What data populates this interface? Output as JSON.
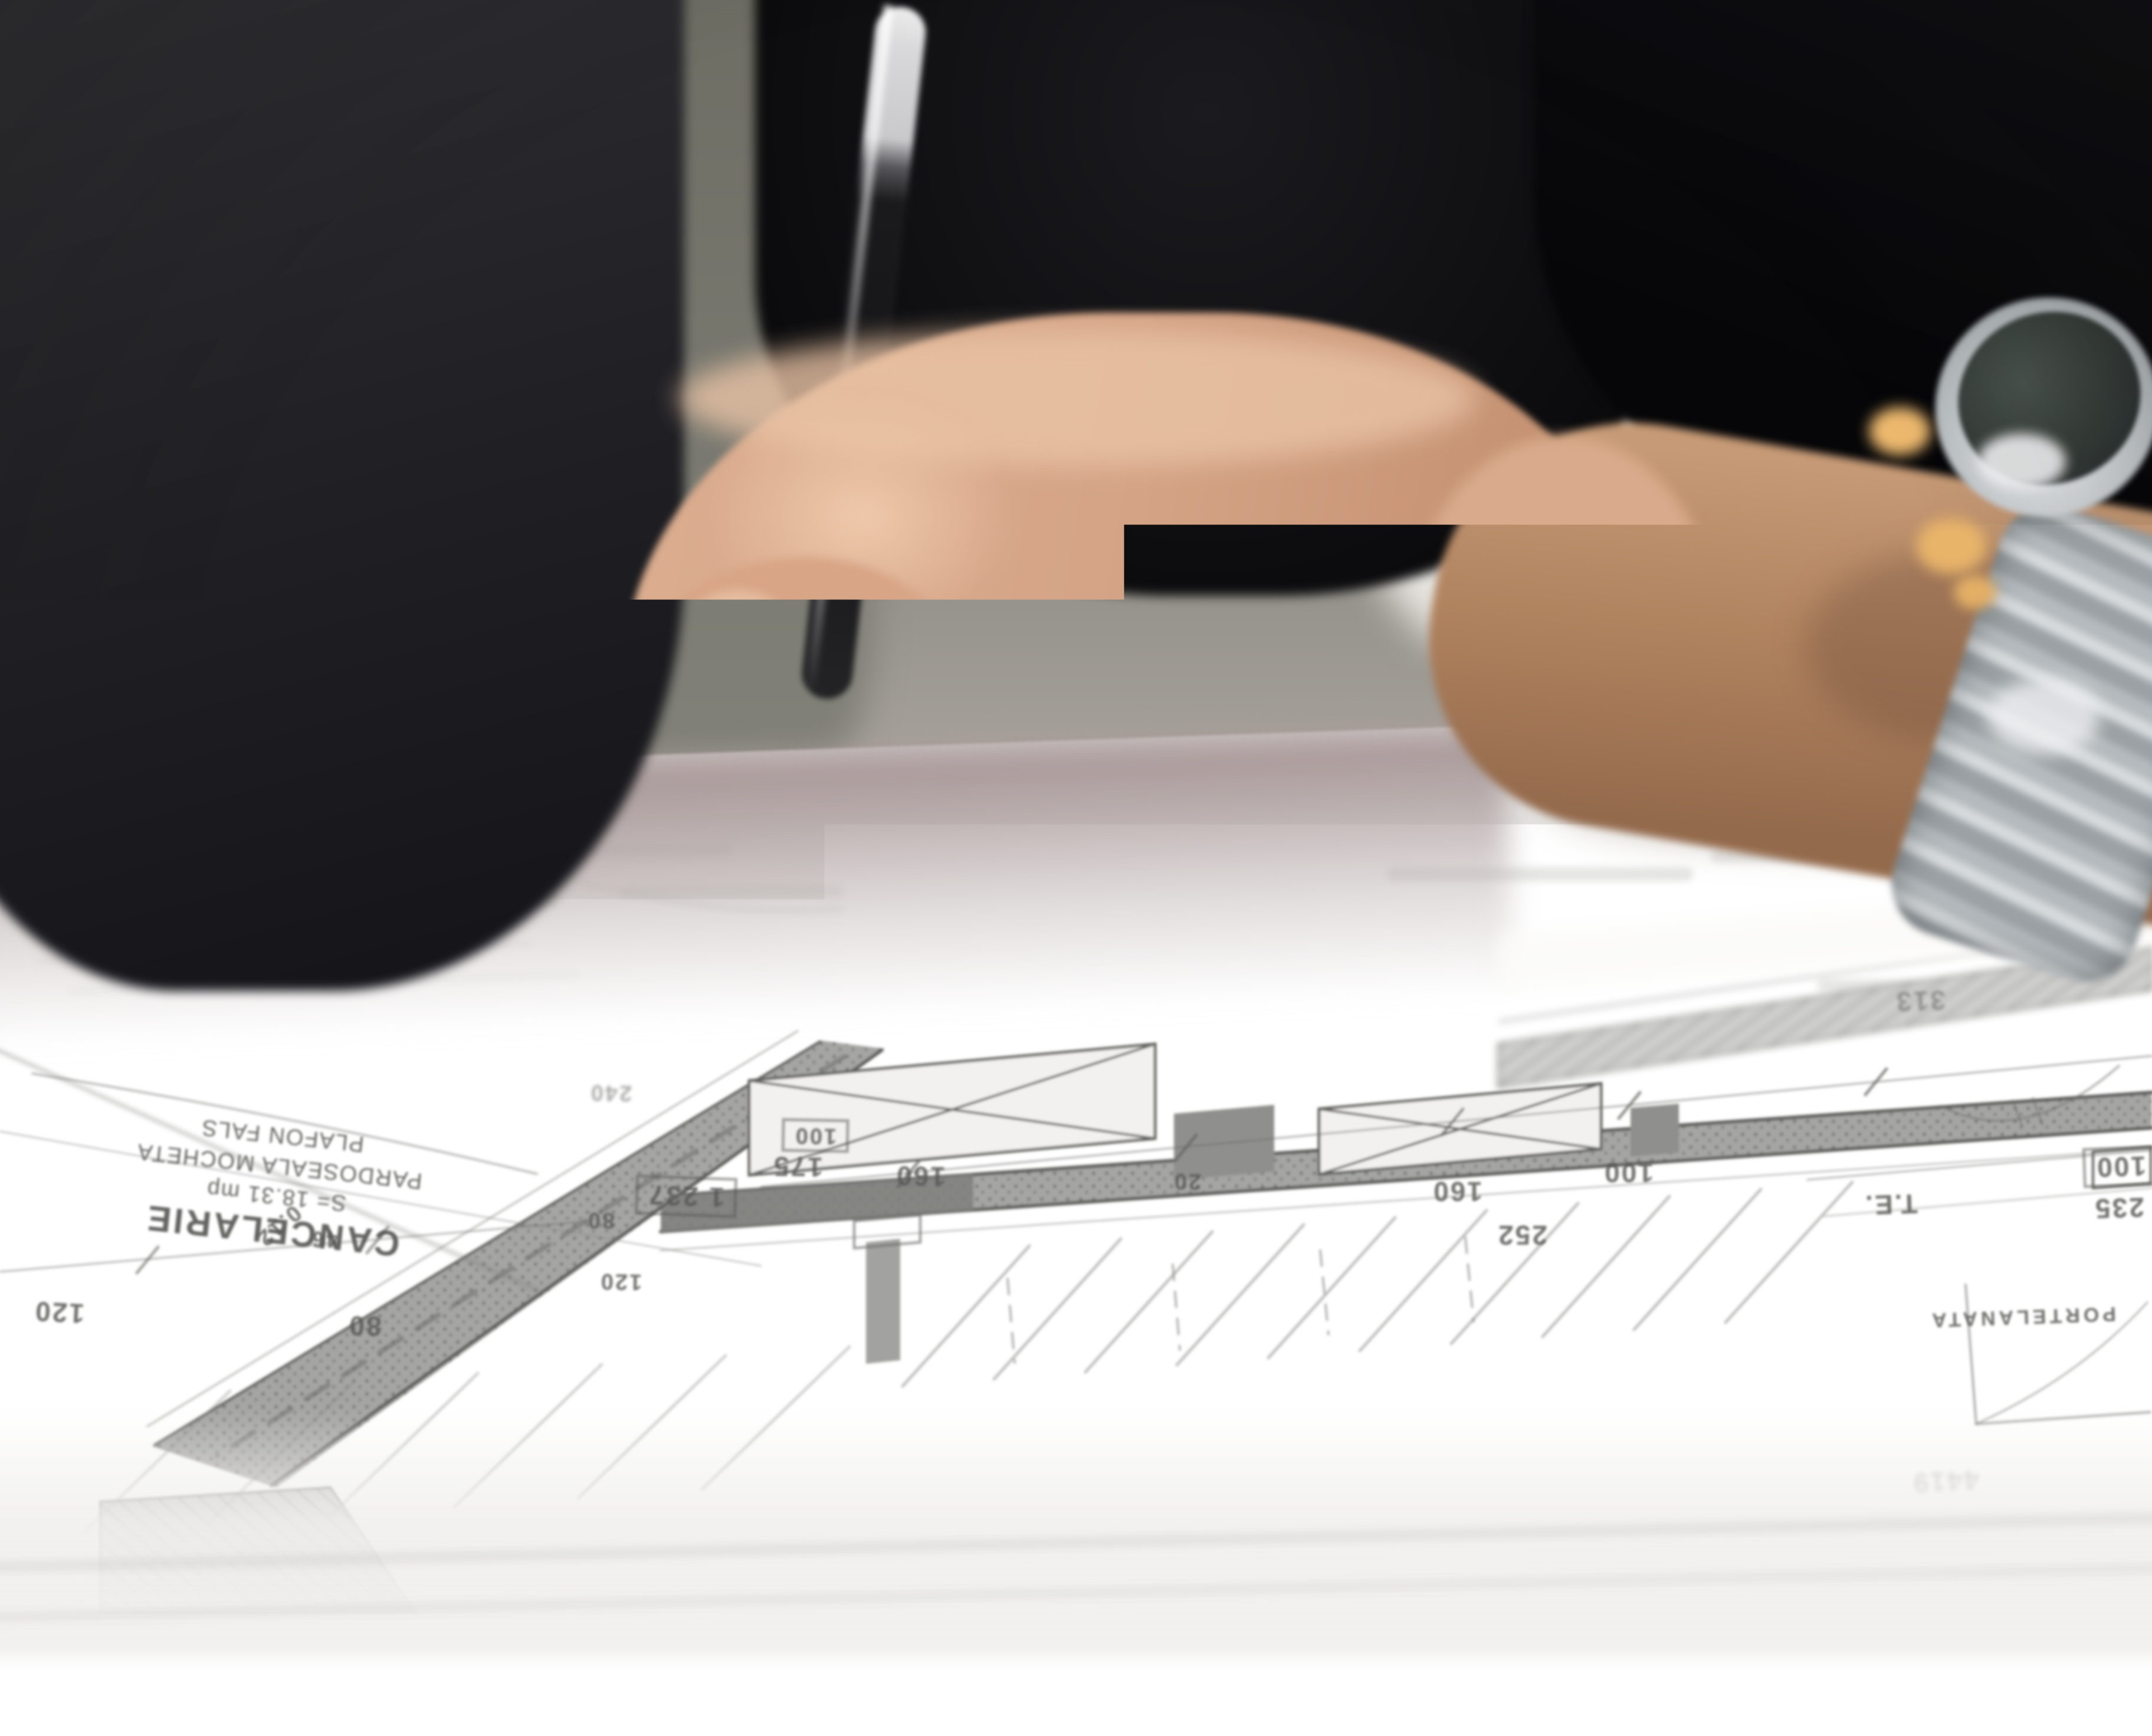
{
  "scene": {
    "type": "photograph",
    "setting": "person leaning over architectural floor-plan blueprints on a desk",
    "objects": {
      "hand": "closed fist resting on the drawings",
      "pen": "black ballpoint pen held upright between the fingers",
      "watch": "steel-bracelet wristwatch with dark dial on the right wrist",
      "clothing": "dark t-shirt sleeves",
      "documents": "architectural floor plans with upside-down annotations"
    },
    "colors": {
      "shirt": "#141316",
      "background_wall": "#7e7d75",
      "wall_patch": "#e7e5e0",
      "skin_light": "#e9c3a5",
      "skin_mid": "#d5a385",
      "skin_shadow": "#a97a5c",
      "forearm": "#b0805f",
      "paper": "#efeeec",
      "plan_line": "#6e6e6c",
      "wall_fill": "#9b9b99",
      "far_blur": "#b3a6a6",
      "watch_dial": "#39403c",
      "watch_steel": "#ccd1d4",
      "gold_glint": "#edb96f",
      "pen_body": "#1a1a1c"
    }
  },
  "blueprint": {
    "room_label": {
      "title": "CANCELARIE",
      "area": "S= 18.31 mp",
      "floor": "PARDOSEALA MOCHETA",
      "ceiling": "PLAFON FALS"
    },
    "labels": {
      "te": "T.E.",
      "finish": "PORTELANATA"
    },
    "dims": [
      "120",
      "80",
      "46",
      "0.12",
      "1 237",
      "175",
      "160",
      "20",
      "160",
      "100",
      "252",
      "313",
      "100",
      "235",
      "4419",
      "240",
      "80",
      "120",
      "100"
    ]
  }
}
